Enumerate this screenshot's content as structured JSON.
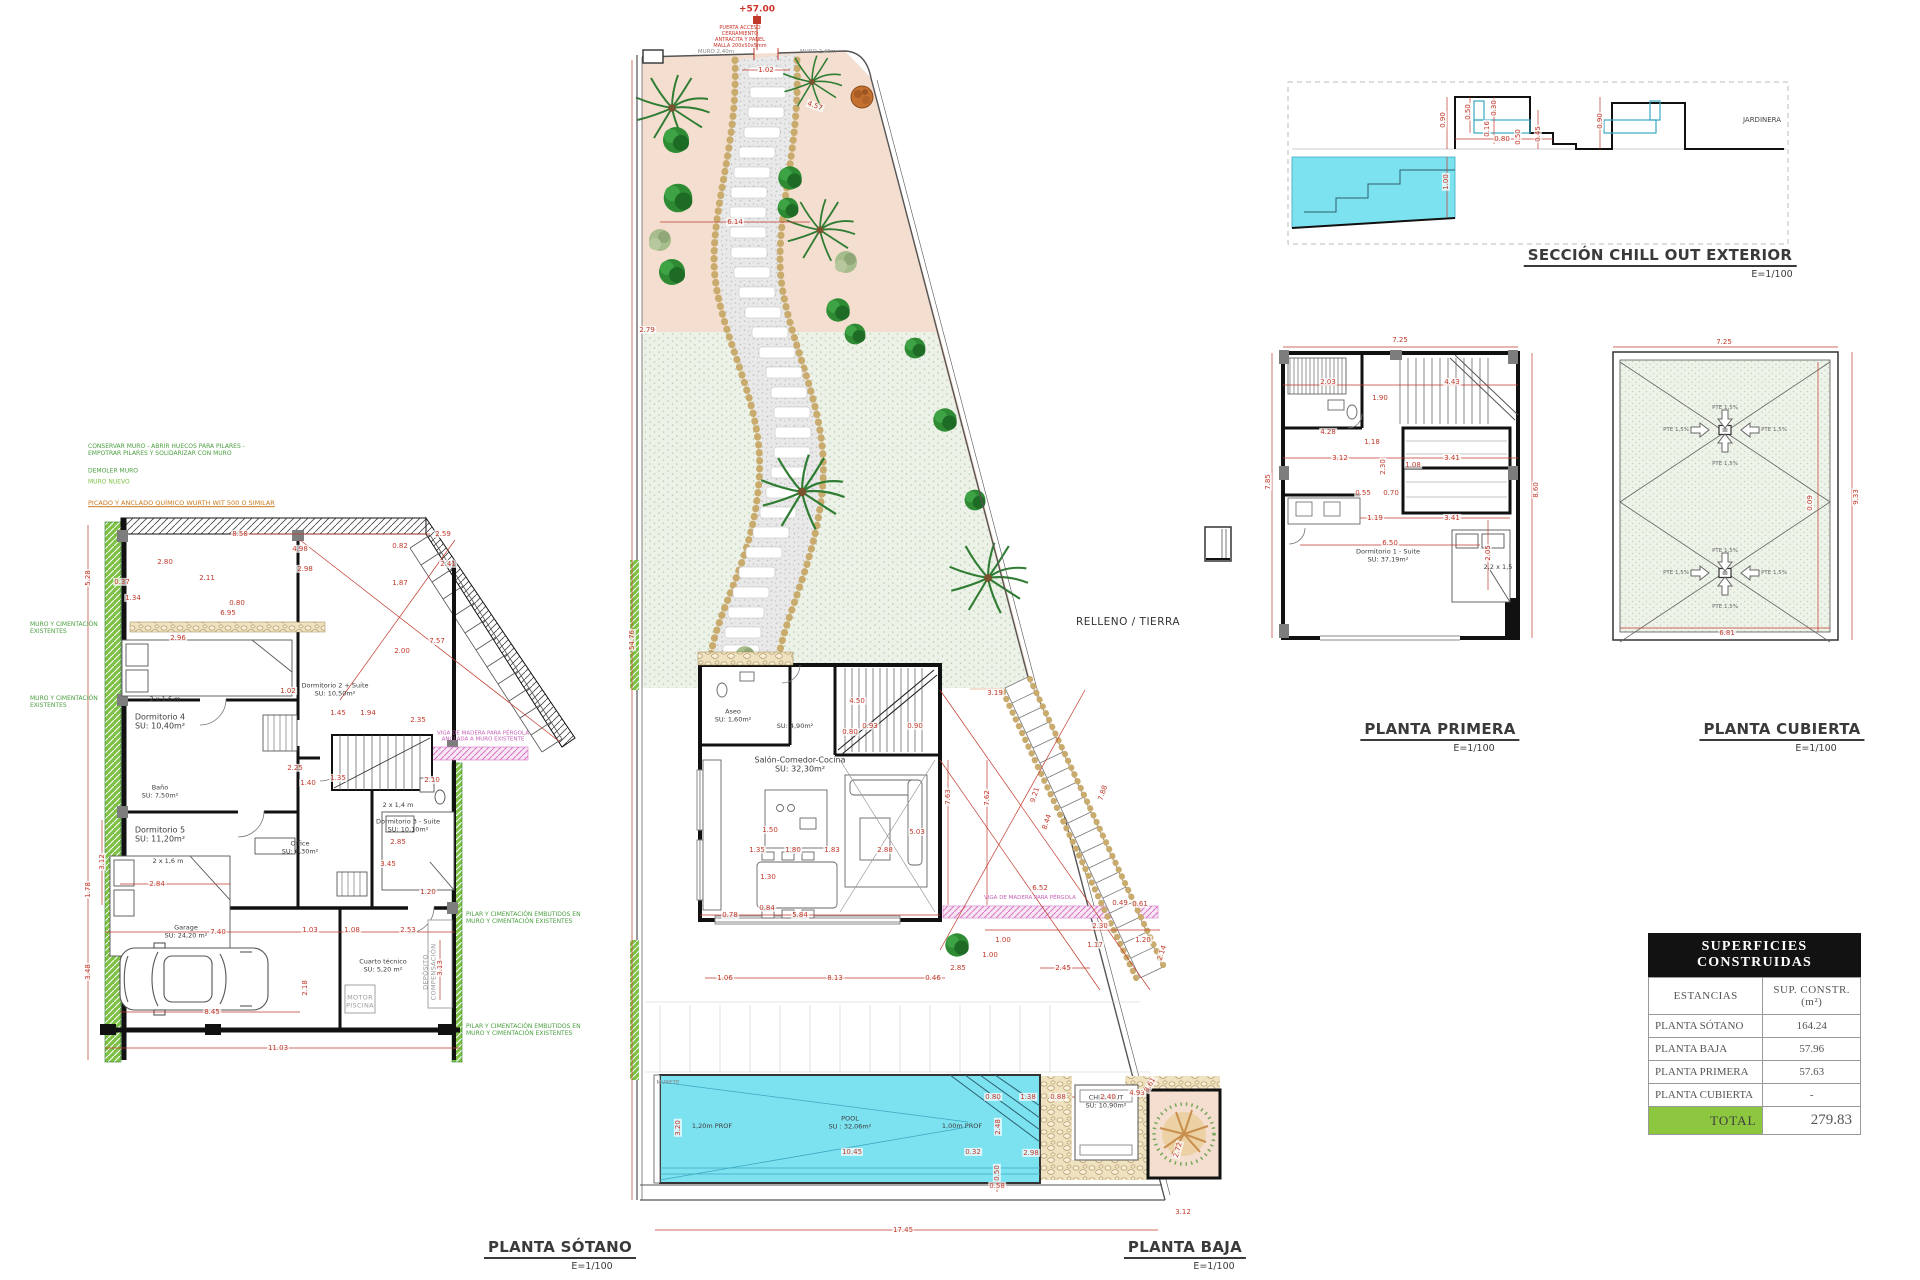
{
  "colors": {
    "dimension_red": "#c0392b",
    "pool_cyan": "#7de2f0",
    "wall_green": "#7cc143",
    "pink_hatch": "#d774c8",
    "lawn_green": "#edf2e8",
    "planting_pink": "#f4decf",
    "stone_tan": "#efe2c0",
    "table_total_green": "#8dc63f",
    "wall_black": "#111111"
  },
  "titles": {
    "sotano": {
      "label": "PLANTA SÓTANO",
      "scale": "E=1/100"
    },
    "baja": {
      "label": "PLANTA BAJA",
      "scale": "E=1/100"
    },
    "primera": {
      "label": "PLANTA PRIMERA",
      "scale": "E=1/100"
    },
    "cubierta": {
      "label": "PLANTA CUBIERTA",
      "scale": "E=1/100"
    },
    "seccion": {
      "label": "SECCIÓN CHILL OUT EXTERIOR",
      "scale": "E=1/100"
    }
  },
  "table": {
    "title": "SUPERFICIES CONSTRUIDAS",
    "col_headers": [
      "ESTANCIAS",
      "SUP. CONSTR. (m²)"
    ],
    "rows": [
      [
        "PLANTA SÓTANO",
        "164.24"
      ],
      [
        "PLANTA BAJA",
        "57.96"
      ],
      [
        "PLANTA PRIMERA",
        "57.63"
      ],
      [
        "PLANTA CUBIERTA",
        "-"
      ]
    ],
    "total_label": "TOTAL",
    "total_value": "279.83"
  },
  "labels": [
    [
      88,
      450,
      "CONSERVAR MURO - ABRIR HUECOS PARA PILARES -\nEMPOTRAR PILARES Y SOLIDARIZAR CON MURO",
      "note-green la"
    ],
    [
      88,
      471,
      "DEMOLER MURO",
      "note-green la"
    ],
    [
      88,
      482,
      "MURO NUEVO",
      "note-green2 la"
    ],
    [
      88,
      504,
      "PICADO Y ANCLADO QUÍMICO WURTH WIT 500 O SIMILAR",
      "note-orange la"
    ],
    [
      466,
      918,
      "PILAR Y CIMENTACIÓN EMBUTIDOS EN\nMURO Y CIMENTACIÓN EXISTENTES",
      "note-green la"
    ],
    [
      466,
      1030,
      "PILAR Y CIMENTACIÓN EMBUTIDOS EN\nMURO Y CIMENTACIÓN EXISTENTES",
      "note-green la"
    ],
    [
      30,
      628,
      "MURO Y CIMENTACIÓN\nEXISTENTES",
      "note-green la"
    ],
    [
      30,
      702,
      "MURO Y CIMENTACIÓN\nEXISTENTES",
      "note-green la"
    ],
    [
      483,
      737,
      "VIGA DE MADERA PARA PÉRGOLA\nANCLADA A MURO EXISTENTE",
      "note-magenta"
    ],
    [
      160,
      722,
      "Dormitorio 4\nSU: 10,40m²",
      "room"
    ],
    [
      160,
      792,
      "Baño\nSU: 7,50m²",
      "room-sm"
    ],
    [
      160,
      835,
      "Dormitorio 5\nSU: 11,20m²",
      "room"
    ],
    [
      335,
      690,
      "Dormitorio 2 + Suite\nSU: 10,50m²",
      "room-sm"
    ],
    [
      300,
      848,
      "Office\nSU: 6,30m²",
      "room-sm"
    ],
    [
      408,
      826,
      "Dormitorio 3 - Suite\nSU: 10,10m²",
      "room-sm"
    ],
    [
      186,
      932,
      "Garage\nSU: 24,20 m²",
      "room-sm"
    ],
    [
      383,
      966,
      "Cuarto técnico\nSU: 5,20 m²",
      "room-sm"
    ],
    [
      360,
      1002,
      "MOTOR\nPISCINA",
      "note-grey"
    ],
    [
      430,
      972,
      "DEPÓSITO\nCOMPENSACIÓN",
      "note-grey",
      -90
    ],
    [
      165,
      700,
      "2 x 1,6 m",
      "room-sm"
    ],
    [
      168,
      862,
      "2 x 1,6 m",
      "room-sm"
    ],
    [
      398,
      806,
      "2 x 1,4 m",
      "room-sm"
    ],
    [
      165,
      562,
      "2.80"
    ],
    [
      122,
      582,
      "0.37"
    ],
    [
      207,
      578,
      "2.11"
    ],
    [
      133,
      598,
      "1.34"
    ],
    [
      240,
      534,
      "8.58"
    ],
    [
      300,
      549,
      "4.98"
    ],
    [
      305,
      569,
      "2.98"
    ],
    [
      237,
      603,
      "0.80"
    ],
    [
      228,
      613,
      "6.95"
    ],
    [
      178,
      638,
      "2.96"
    ],
    [
      400,
      546,
      "0.82"
    ],
    [
      443,
      534,
      "2.59"
    ],
    [
      448,
      564,
      "2.41"
    ],
    [
      400,
      583,
      "1.87"
    ],
    [
      437,
      641,
      "7.57"
    ],
    [
      402,
      651,
      "2.00"
    ],
    [
      88,
      578,
      "5.28",
      "dim",
      -90
    ],
    [
      288,
      691,
      "1.02"
    ],
    [
      338,
      713,
      "1.45"
    ],
    [
      368,
      713,
      "1.94"
    ],
    [
      418,
      720,
      "2.35"
    ],
    [
      295,
      768,
      "2.25"
    ],
    [
      308,
      783,
      "1.40"
    ],
    [
      338,
      778,
      "1.35"
    ],
    [
      432,
      780,
      "2.10"
    ],
    [
      398,
      842,
      "2.85"
    ],
    [
      388,
      864,
      "3.45"
    ],
    [
      157,
      884,
      "2.84"
    ],
    [
      428,
      892,
      "1.20"
    ],
    [
      88,
      890,
      "1.78",
      "dim",
      -90
    ],
    [
      88,
      972,
      "3.48",
      "dim",
      -90
    ],
    [
      218,
      932,
      "7.40"
    ],
    [
      310,
      930,
      "1.03"
    ],
    [
      352,
      930,
      "1.08"
    ],
    [
      408,
      930,
      "2.53"
    ],
    [
      212,
      1012,
      "8.45"
    ],
    [
      305,
      988,
      "2.18",
      "dim",
      -90
    ],
    [
      440,
      968,
      "3.13",
      "dim",
      -90
    ],
    [
      278,
      1048,
      "11.03"
    ],
    [
      102,
      862,
      "3.12",
      "dim",
      -90
    ],
    [
      757,
      10,
      "+57.00",
      "level"
    ],
    [
      740,
      38,
      "PUERTA ACCESO\nCERRAMIENTO\nANTRACITA Y PANEL\nMALLA 200x50x5mm",
      "note-red"
    ],
    [
      716,
      52,
      "MURO 2,40m",
      "note-grey-sm"
    ],
    [
      818,
      52,
      "MURO 2,40m",
      "note-grey-sm"
    ],
    [
      1128,
      622,
      "RELLENO / TIERRA",
      "zone"
    ],
    [
      800,
      765,
      "Salón-Comedor-Cocina\nSU: 32,30m²",
      "room"
    ],
    [
      733,
      716,
      "Aseo\nSU: 1,60m²",
      "room-sm"
    ],
    [
      795,
      727,
      "SU: 4,90m²",
      "room-sm"
    ],
    [
      850,
      1123,
      "POOL\nSU : 32,06m²",
      "room-sm"
    ],
    [
      712,
      1127,
      "1,20m PROF",
      "room-sm"
    ],
    [
      962,
      1127,
      "1,00m PROF",
      "room-sm"
    ],
    [
      668,
      1083,
      "MURETE",
      "note-grey-sm"
    ],
    [
      1106,
      1102,
      "CHILL OUT\nSU: 10,90m²",
      "room-sm"
    ],
    [
      1030,
      898,
      "VIGA DE MADERA PARA PÉRGOLA",
      "note-magenta"
    ],
    [
      766,
      70,
      "1.02"
    ],
    [
      735,
      222,
      "6.14"
    ],
    [
      647,
      330,
      "2.79"
    ],
    [
      815,
      106,
      "4.57",
      "dim",
      20
    ],
    [
      632,
      640,
      "54.76",
      "dim",
      -90
    ],
    [
      995,
      693,
      "3.19"
    ],
    [
      948,
      797,
      "7.63",
      "dim",
      -90
    ],
    [
      987,
      798,
      "7.62",
      "dim",
      -90
    ],
    [
      1035,
      795,
      "9.21",
      "dim",
      -72
    ],
    [
      1047,
      822,
      "8.44",
      "dim",
      -72
    ],
    [
      1103,
      793,
      "7.88",
      "dim",
      -72
    ],
    [
      1040,
      888,
      "6.52"
    ],
    [
      1120,
      903,
      "0.49"
    ],
    [
      1140,
      904,
      "0.61"
    ],
    [
      1100,
      926,
      "2.30"
    ],
    [
      1003,
      940,
      "1.00"
    ],
    [
      990,
      955,
      "1.00"
    ],
    [
      1095,
      945,
      "1.17"
    ],
    [
      1143,
      940,
      "1.20"
    ],
    [
      1162,
      953,
      "2.14",
      "dim",
      -72
    ],
    [
      1063,
      968,
      "2.45"
    ],
    [
      958,
      968,
      "2.85"
    ],
    [
      835,
      978,
      "8.13"
    ],
    [
      725,
      978,
      "1.06"
    ],
    [
      933,
      978,
      "0.46"
    ],
    [
      800,
      915,
      "5.84"
    ],
    [
      730,
      915,
      "0.78"
    ],
    [
      770,
      830,
      "1.50"
    ],
    [
      757,
      850,
      "1.35"
    ],
    [
      793,
      850,
      "1.80"
    ],
    [
      832,
      850,
      "1.83"
    ],
    [
      885,
      850,
      "2.88"
    ],
    [
      917,
      832,
      "5.03"
    ],
    [
      768,
      877,
      "1.30"
    ],
    [
      767,
      908,
      "0.84"
    ],
    [
      857,
      701,
      "4.50"
    ],
    [
      850,
      732,
      "0.80"
    ],
    [
      870,
      726,
      "0.93"
    ],
    [
      915,
      726,
      "0.90"
    ],
    [
      852,
      1152,
      "10.45"
    ],
    [
      678,
      1128,
      "3.20",
      "dim",
      -90
    ],
    [
      973,
      1152,
      "0.32"
    ],
    [
      993,
      1097,
      "0.80"
    ],
    [
      1028,
      1097,
      "1.38"
    ],
    [
      1058,
      1097,
      "0.88"
    ],
    [
      1108,
      1097,
      "2.40"
    ],
    [
      1137,
      1093,
      "4.93"
    ],
    [
      998,
      1127,
      "2.48",
      "dim",
      -90
    ],
    [
      1031,
      1153,
      "2.98"
    ],
    [
      997,
      1173,
      "0.50",
      "dim",
      -90
    ],
    [
      997,
      1186,
      "0.58"
    ],
    [
      903,
      1230,
      "17.45"
    ],
    [
      1183,
      1212,
      "3.12"
    ],
    [
      1178,
      1150,
      "2.72",
      "dim",
      -75
    ],
    [
      1150,
      1085,
      "8.61",
      "dim",
      -60
    ],
    [
      1400,
      340,
      "7.25"
    ],
    [
      1328,
      382,
      "2.03"
    ],
    [
      1452,
      382,
      "4.43"
    ],
    [
      1380,
      398,
      "1.90"
    ],
    [
      1328,
      432,
      "4.28"
    ],
    [
      1372,
      442,
      "1.18"
    ],
    [
      1340,
      458,
      "3.12"
    ],
    [
      1452,
      458,
      "3.41"
    ],
    [
      1383,
      467,
      "2.30",
      "dim",
      -90
    ],
    [
      1413,
      465,
      "1.08"
    ],
    [
      1268,
      482,
      "7.85",
      "dim",
      -90
    ],
    [
      1536,
      490,
      "8.60",
      "dim",
      -90
    ],
    [
      1363,
      493,
      "0.55"
    ],
    [
      1391,
      493,
      "0.70"
    ],
    [
      1375,
      518,
      "1.19"
    ],
    [
      1452,
      518,
      "3.41"
    ],
    [
      1390,
      543,
      "6.50"
    ],
    [
      1488,
      553,
      "2.05",
      "dim",
      -90
    ],
    [
      1498,
      568,
      "2,2 x 1,5",
      "room-sm"
    ],
    [
      1388,
      556,
      "Dormitorio 1 - Suite\nSU: 37,19m²",
      "room-sm"
    ],
    [
      1724,
      342,
      "7.25"
    ],
    [
      1856,
      497,
      "9.33",
      "dim",
      -90
    ],
    [
      1810,
      503,
      "0.09",
      "dim",
      -90
    ],
    [
      1727,
      633,
      "6.81"
    ],
    [
      1725,
      408,
      "PTE 1,5%",
      "pte"
    ],
    [
      1725,
      464,
      "PTE 1,5%",
      "pte"
    ],
    [
      1676,
      430,
      "PTE 1,5%",
      "pte"
    ],
    [
      1774,
      430,
      "PTE 1,5%",
      "pte"
    ],
    [
      1725,
      551,
      "PTE 1,5%",
      "pte"
    ],
    [
      1725,
      607,
      "PTE 1,5%",
      "pte"
    ],
    [
      1676,
      573,
      "PTE 1,5%",
      "pte"
    ],
    [
      1774,
      573,
      "PTE 1,5%",
      "pte"
    ],
    [
      1762,
      120,
      "JARDINERA",
      "note-dark-sm"
    ],
    [
      1443,
      120,
      "0.90",
      "dim",
      -90
    ],
    [
      1468,
      112,
      "0.50",
      "dim",
      -90
    ],
    [
      1494,
      108,
      "0.30",
      "dim",
      -90
    ],
    [
      1487,
      129,
      "0.16",
      "dim",
      -90
    ],
    [
      1502,
      139,
      "0.80"
    ],
    [
      1518,
      137,
      "0.50",
      "dim",
      -90
    ],
    [
      1538,
      134,
      "0.45",
      "dim",
      -90
    ],
    [
      1600,
      121,
      "0.90",
      "dim",
      -90
    ],
    [
      1446,
      182,
      "1.00",
      "dim",
      -90
    ]
  ]
}
